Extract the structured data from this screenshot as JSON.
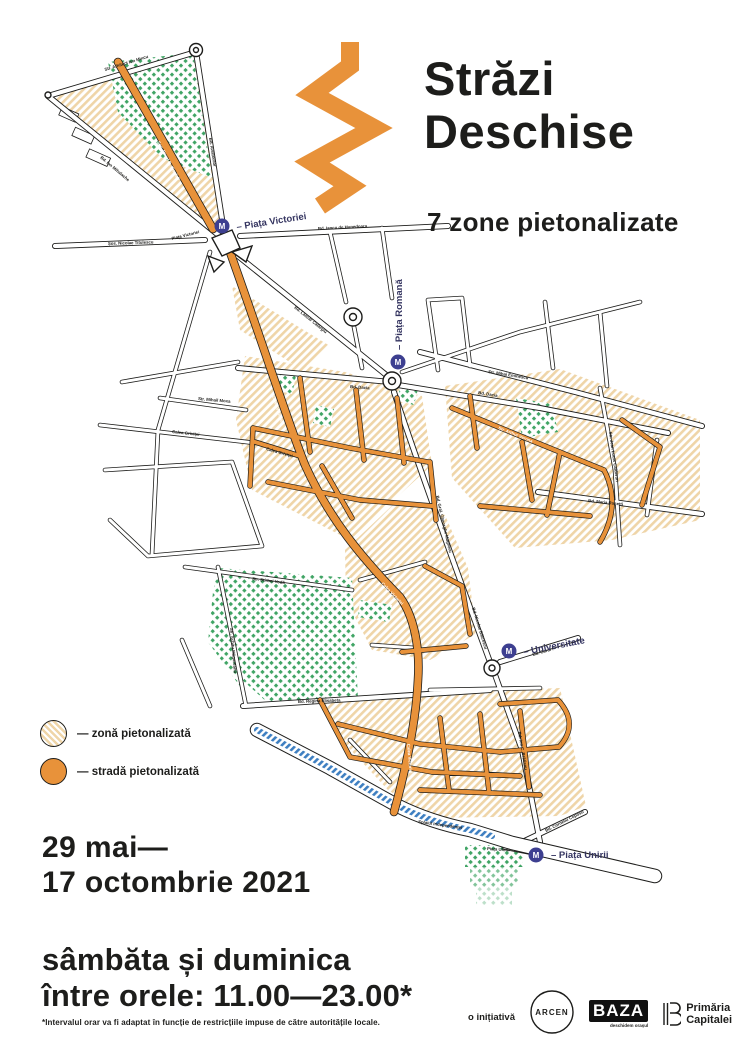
{
  "header": {
    "title_line1": "Străzi",
    "title_line2": "Deschise",
    "subtitle": "7 zone pietonalizate"
  },
  "legend": [
    {
      "swatch": "hatch",
      "label": "— zonă pietonalizată"
    },
    {
      "swatch": "orange",
      "label": "— stradă pietonalizată"
    }
  ],
  "dates": {
    "line1": "29 mai—",
    "line2": "17 octombrie 2021"
  },
  "schedule": {
    "line1": "sâmbăta și duminica",
    "line2": "între orele: 11.00—23.00*",
    "footnote": "*Intervalul orar va fi adaptat în funcție de restricțiile impuse de către autoritățile locale."
  },
  "partners": {
    "intro": "o inițiativă",
    "arcen": "ARCEN",
    "baza": "BAZA",
    "baza_sub": "deschidem orașul",
    "primaria_line1": "Primăria",
    "primaria_line2": "Capitalei"
  },
  "map": {
    "metro_letter": "M",
    "colors": {
      "street_orange": "#E8923A",
      "zone_hatch": "#EFD5A8",
      "park_green": "#3FA464",
      "river_blue": "#3E7FC1",
      "metro_blue": "#3D3F90"
    },
    "stations": [
      {
        "name": "– Piața Victoriei",
        "bx": 222,
        "by": 226,
        "lx": 237,
        "ly": 230,
        "rot": -9
      },
      {
        "name": "– Piața Romană",
        "bx": 398,
        "by": 362,
        "lx": 402,
        "ly": 350,
        "rot": -90
      },
      {
        "name": "– Universitate",
        "bx": 509,
        "by": 651,
        "lx": 524,
        "ly": 655,
        "rot": -11
      },
      {
        "name": "– Piața Unirii",
        "bx": 536,
        "by": 855,
        "lx": 551,
        "ly": 858,
        "rot": 0
      }
    ],
    "street_labels": [
      {
        "t": "Str. Arhitect Ion Mincu",
        "x": 105,
        "y": 71,
        "r": -17,
        "c": ""
      },
      {
        "t": "Bd. Aviatorilor",
        "x": 209,
        "y": 138,
        "r": 81,
        "c": ""
      },
      {
        "t": "Șos. Pavel D. Kiseleff",
        "x": 157,
        "y": 142,
        "r": 62,
        "c": "w"
      },
      {
        "t": "Bd. Ion Mihalache",
        "x": 100,
        "y": 158,
        "r": 40,
        "c": ""
      },
      {
        "t": "Șos. Nicolae Titulescu",
        "x": 108,
        "y": 245,
        "r": -2,
        "c": ""
      },
      {
        "t": "Bd. Iancu de Hunedoara",
        "x": 318,
        "y": 230,
        "r": -3,
        "c": ""
      },
      {
        "t": "Piața Victoriei",
        "x": 172,
        "y": 240,
        "r": -14,
        "c": ""
      },
      {
        "t": "Bd. Lascăr Catargiu",
        "x": 294,
        "y": 308,
        "r": 39,
        "c": ""
      },
      {
        "t": "Bd. Dacia",
        "x": 350,
        "y": 388,
        "r": 4,
        "c": ""
      },
      {
        "t": "Bd. Dacia",
        "x": 478,
        "y": 394,
        "r": 9,
        "c": ""
      },
      {
        "t": "Str. Mihai Eminescu",
        "x": 488,
        "y": 373,
        "r": 9,
        "c": ""
      },
      {
        "t": "Calea Victoriei",
        "x": 272,
        "y": 396,
        "r": 72,
        "c": "w"
      },
      {
        "t": "Calea Victoriei",
        "x": 381,
        "y": 584,
        "r": 46,
        "c": "w"
      },
      {
        "t": "Calea Victoriei",
        "x": 407,
        "y": 744,
        "r": 85,
        "c": "w"
      },
      {
        "t": "Calea Griviței",
        "x": 172,
        "y": 433,
        "r": 6,
        "c": ""
      },
      {
        "t": "Calea Griviței",
        "x": 266,
        "y": 450,
        "r": 16,
        "c": ""
      },
      {
        "t": "Str. Mihail Moxa",
        "x": 198,
        "y": 400,
        "r": 5,
        "c": ""
      },
      {
        "t": "Bd. Gral. Gheorghe Magheru",
        "x": 436,
        "y": 496,
        "r": 77,
        "c": ""
      },
      {
        "t": "Bd. Nicolae Bălcescu",
        "x": 472,
        "y": 608,
        "r": 73,
        "c": ""
      },
      {
        "t": "Str. Jean Louis Calderon",
        "x": 609,
        "y": 432,
        "r": 82,
        "c": ""
      },
      {
        "t": "Bd. Maria Rosetti",
        "x": 588,
        "y": 502,
        "r": 6,
        "c": ""
      },
      {
        "t": "Str. Arthur Verona",
        "x": 498,
        "y": 429,
        "r": 22,
        "c": "w"
      },
      {
        "t": "Bd. Carol I",
        "x": 533,
        "y": 656,
        "r": -16,
        "c": ""
      },
      {
        "t": "Bd. Regina Elisabeta",
        "x": 298,
        "y": 703,
        "r": -2,
        "c": ""
      },
      {
        "t": "Str. Știrbei Vodă",
        "x": 252,
        "y": 580,
        "r": 7,
        "c": ""
      },
      {
        "t": "Str. Schitu Măgureanu",
        "x": 230,
        "y": 628,
        "r": 85,
        "c": ""
      },
      {
        "t": "Splaiul Independenței",
        "x": 418,
        "y": 823,
        "r": 8,
        "c": ""
      },
      {
        "t": "Piața Unirii",
        "x": 487,
        "y": 850,
        "r": 4,
        "c": ""
      },
      {
        "t": "Bd. Corneliu Coposu",
        "x": 546,
        "y": 832,
        "r": -27,
        "c": ""
      },
      {
        "t": "Bd. Ion C. Brătianu",
        "x": 518,
        "y": 732,
        "r": 80,
        "c": ""
      }
    ]
  }
}
